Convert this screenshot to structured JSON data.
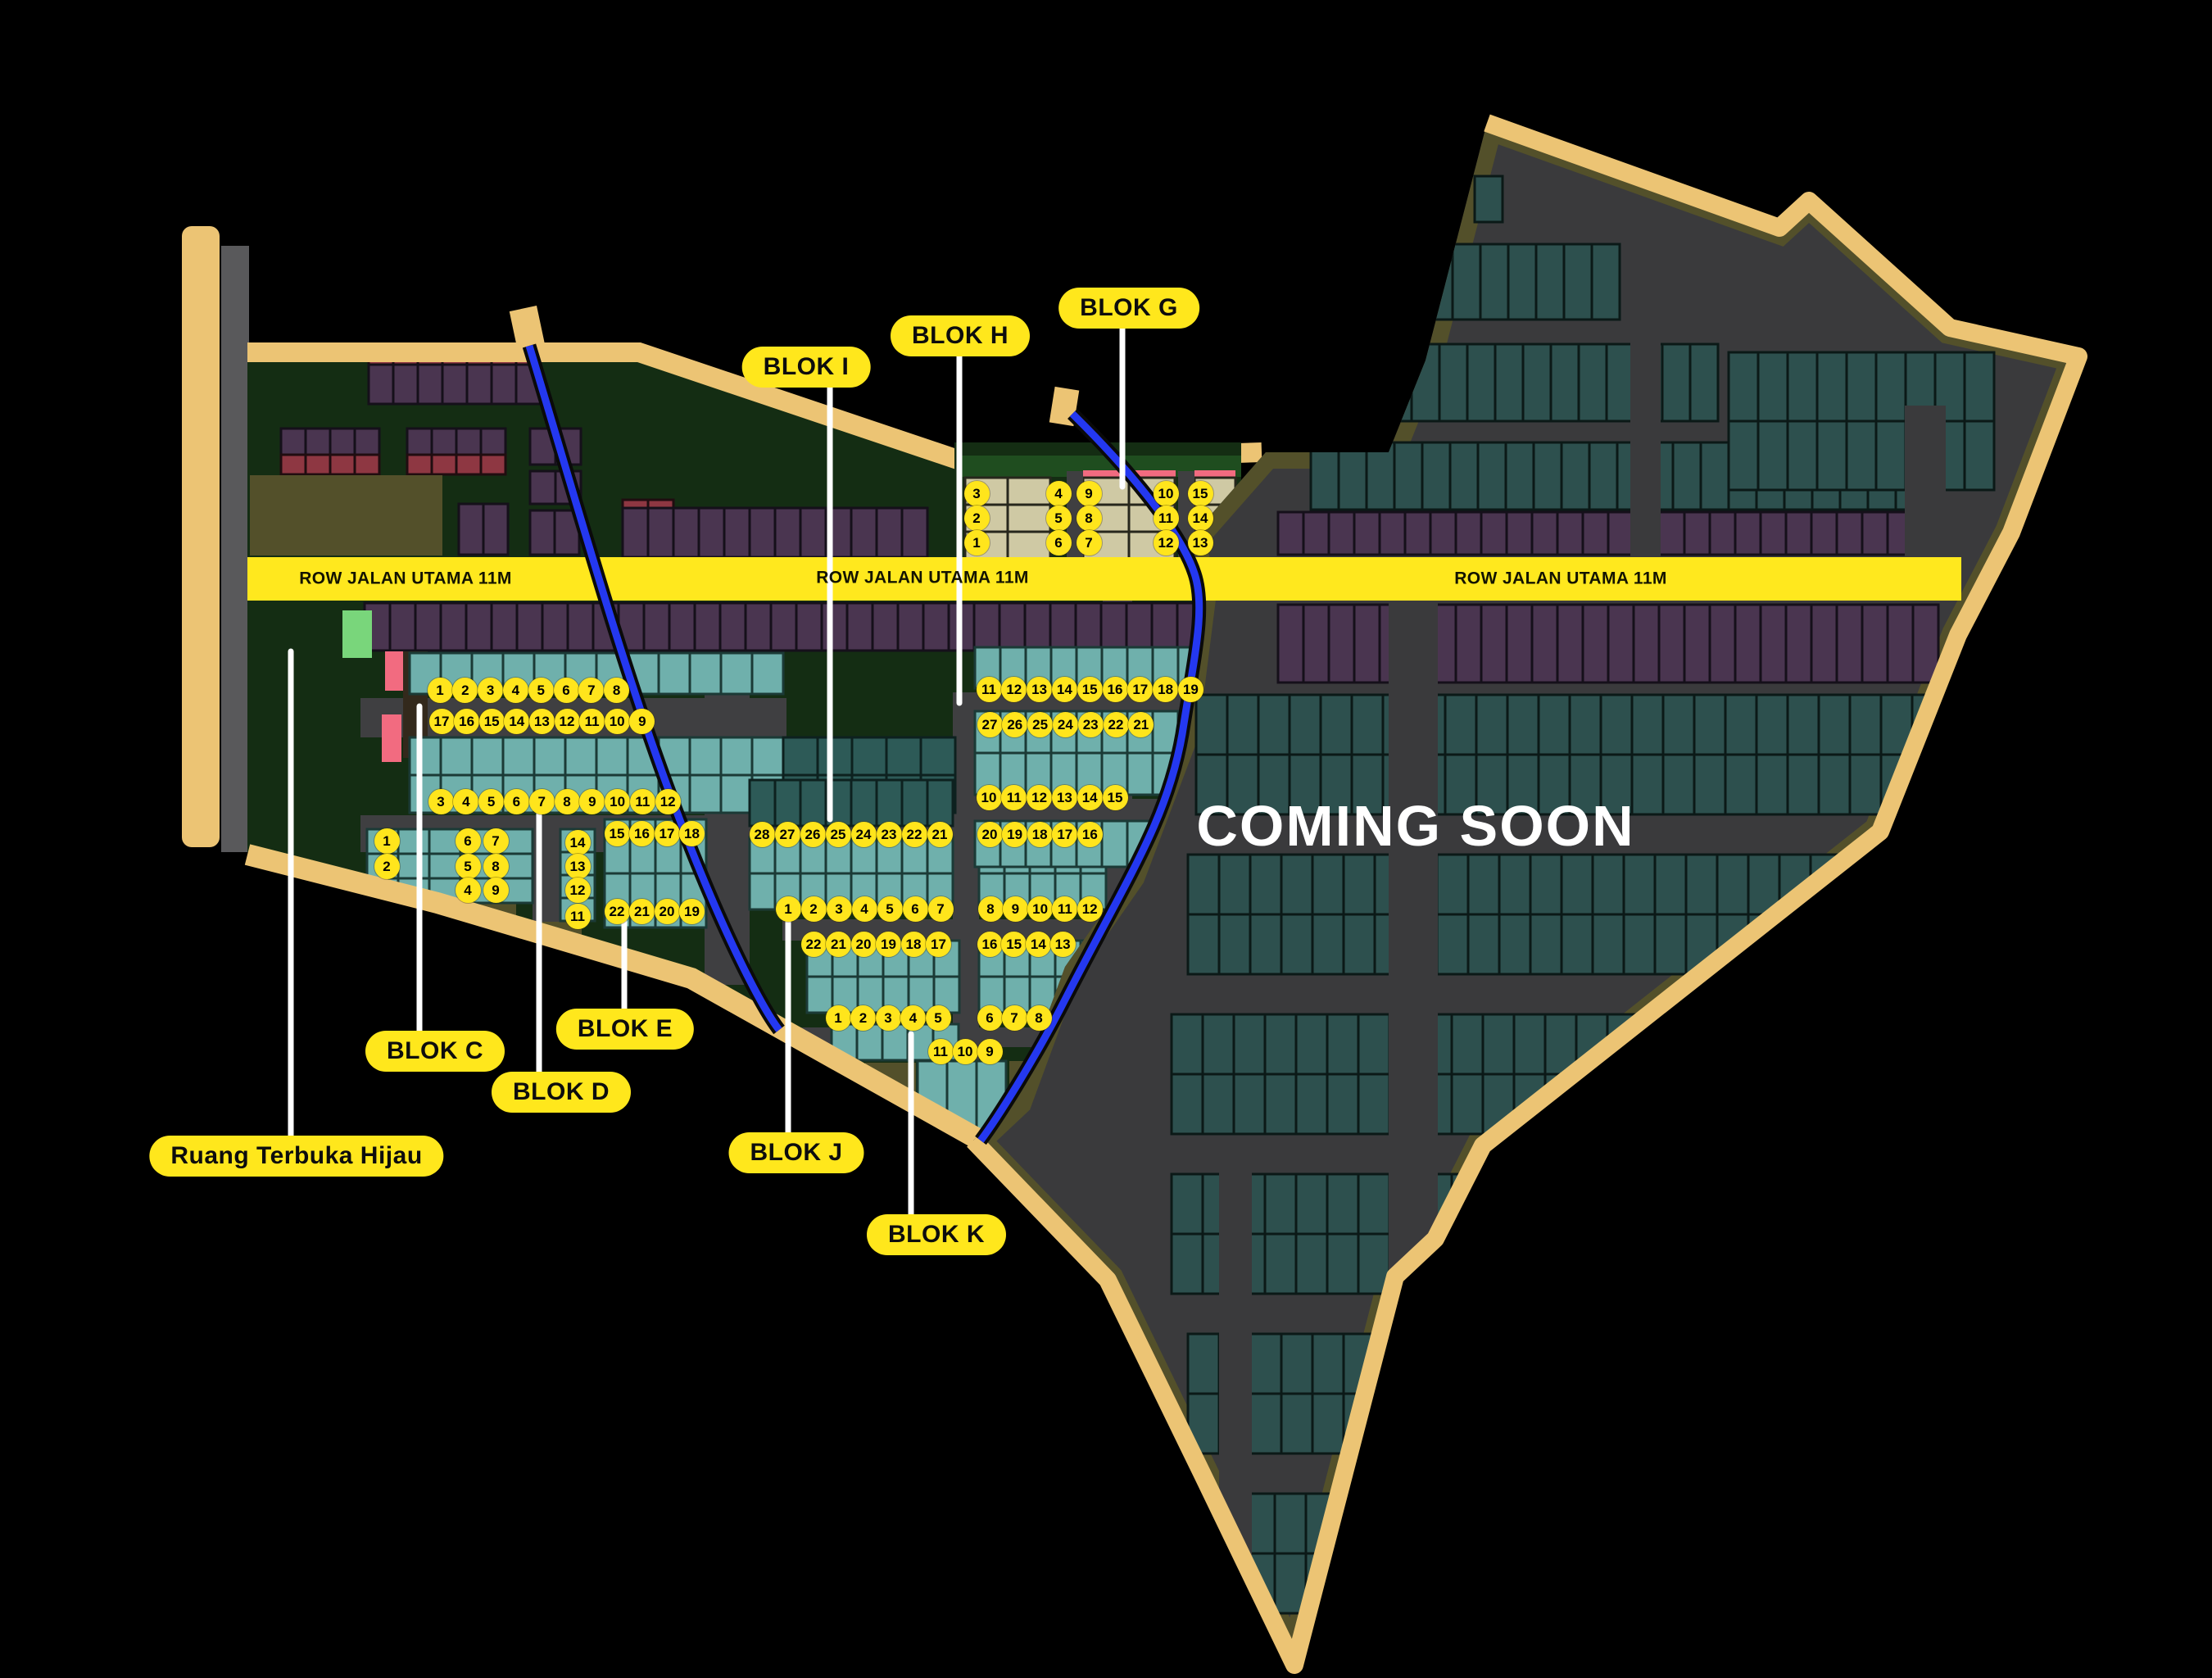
{
  "map": {
    "coming_soon": "COMING SOON",
    "road_labels": [
      "ROW JALAN UTAMA 11M",
      "ROW JALAN UTAMA 11M",
      "ROW JALAN UTAMA 11M"
    ],
    "block_labels": {
      "blok_c": "BLOK C",
      "blok_d": "BLOK D",
      "blok_e": "BLOK E",
      "blok_g": "BLOK G",
      "blok_h": "BLOK H",
      "blok_i": "BLOK I",
      "blok_j": "BLOK J",
      "blok_k": "BLOK K",
      "rth": "Ruang Terbuka Hijau"
    },
    "colors": {
      "label_yellow": "#ffe71c",
      "road_band_yellow": "#ffe81e",
      "river_blue": "#2438f0",
      "boundary_tan": "#ecc474",
      "lot_teal": "#6fb0ac",
      "lot_purple": "#4a3550",
      "lot_beige": "#cfc9a4",
      "coming_soon_white": "#ffffff"
    }
  },
  "lot_rows": {
    "g1": [
      3,
      4,
      9,
      10,
      15
    ],
    "g2": [
      2,
      5,
      8,
      11,
      14
    ],
    "g3": [
      1,
      6,
      7,
      12,
      13
    ],
    "c1": [
      1,
      2,
      3,
      4,
      5,
      6,
      7,
      8
    ],
    "c2": [
      17,
      16,
      15,
      14,
      13,
      12,
      11,
      10,
      9
    ],
    "d_top": [
      3,
      4,
      5,
      6,
      7,
      8,
      9,
      10,
      11,
      12
    ],
    "d_left": [
      1,
      2
    ],
    "d_m1": [
      6,
      5,
      4
    ],
    "d_m2": [
      7,
      8,
      9
    ],
    "d_right": [
      14,
      13,
      12,
      11
    ],
    "e_top": [
      15,
      16,
      17,
      18
    ],
    "e_bottom": [
      22,
      21,
      20,
      19
    ],
    "i_top": [
      28,
      27,
      26,
      25,
      24,
      23,
      22,
      21
    ],
    "i_mid": [
      1,
      2,
      3,
      4,
      5,
      6,
      7
    ],
    "i_low": [
      22,
      21,
      20,
      19,
      18,
      17
    ],
    "j_row": [
      1,
      2,
      3,
      4,
      5
    ],
    "k_row": [
      11,
      10,
      9
    ],
    "h_row1": [
      11,
      12,
      13,
      14,
      15,
      16,
      17,
      18,
      19
    ],
    "h_row2": [
      27,
      26,
      25,
      24,
      23,
      22,
      21
    ],
    "h_row3": [
      10,
      11,
      12,
      13,
      14,
      15
    ],
    "h_row4": [
      20,
      19,
      18,
      17,
      16
    ],
    "h_row5": [
      8,
      9,
      10,
      11,
      12
    ],
    "h_row6": [
      16,
      15,
      14,
      13
    ],
    "h_row7": [
      6,
      7,
      8
    ]
  }
}
